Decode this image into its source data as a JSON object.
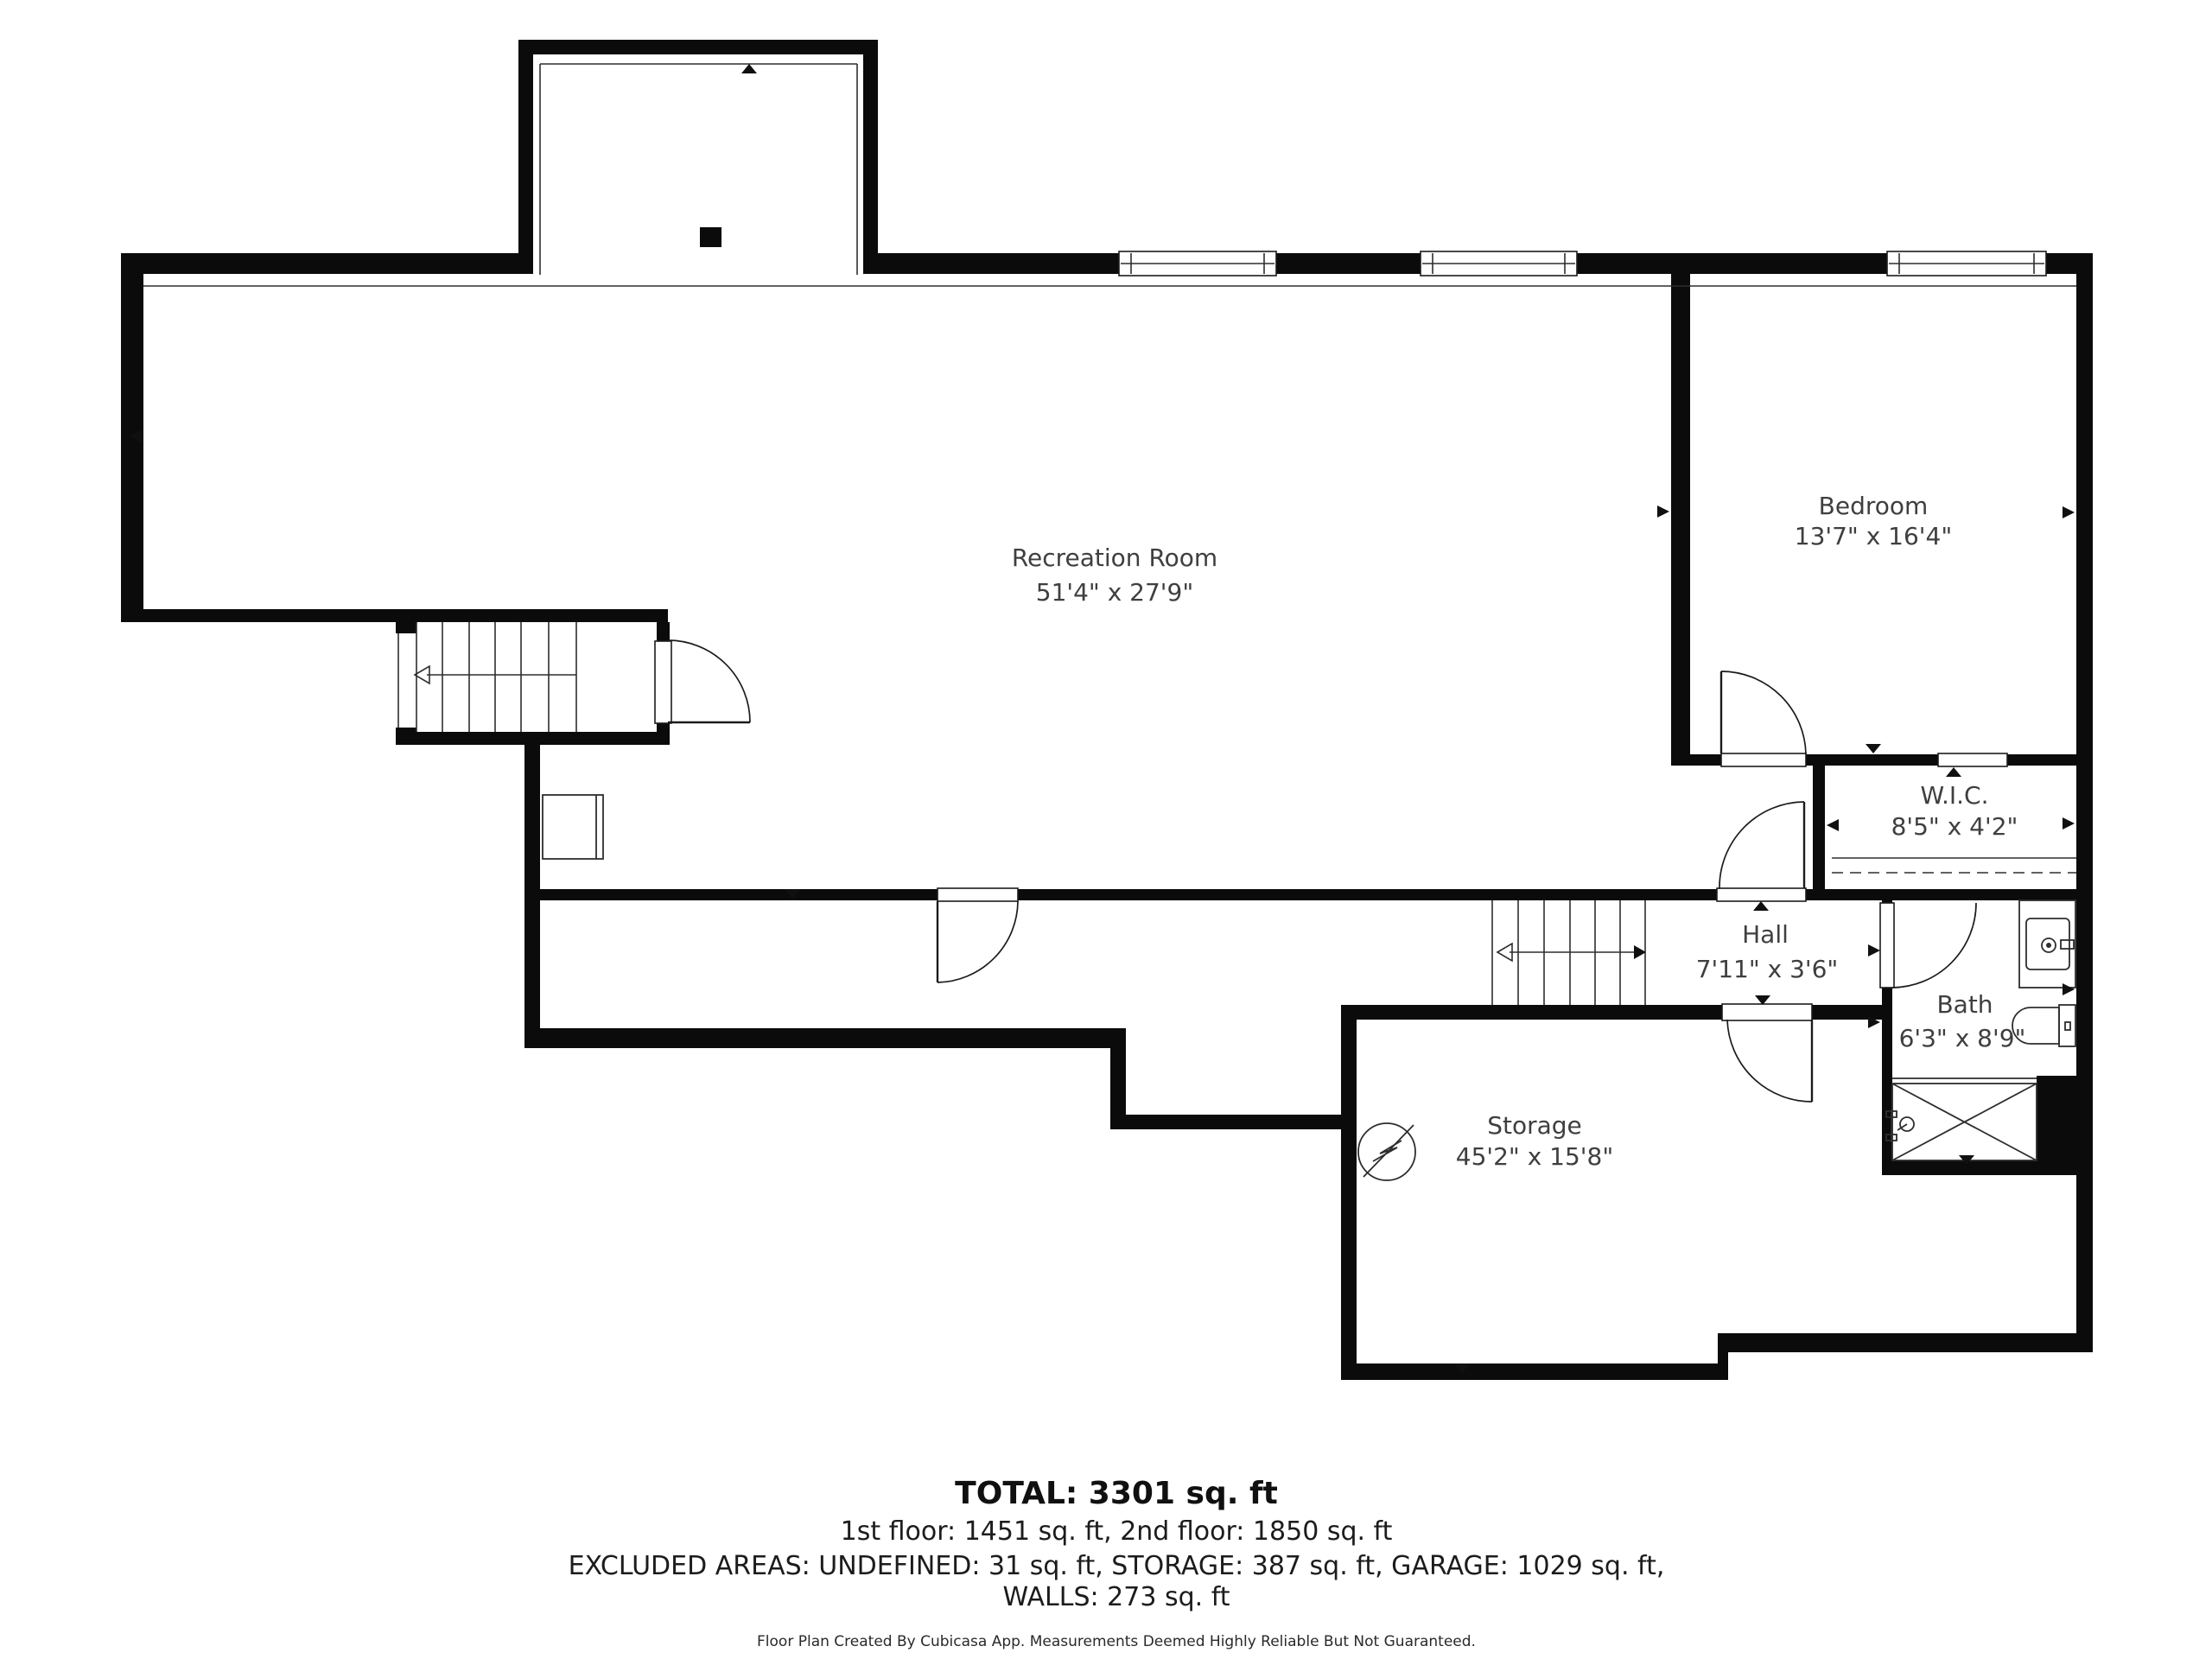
{
  "floorplan": {
    "rooms": [
      {
        "id": "recreation-room",
        "name": "Recreation Room",
        "dims": "51'4\" x 27'9\""
      },
      {
        "id": "bedroom",
        "name": "Bedroom",
        "dims": "13'7\" x 16'4\""
      },
      {
        "id": "wic",
        "name": "W.I.C.",
        "dims": "8'5\" x 4'2\""
      },
      {
        "id": "hall",
        "name": "Hall",
        "dims": "7'11\" x 3'6\""
      },
      {
        "id": "bath",
        "name": "Bath",
        "dims": "6'3\" x 8'9\""
      },
      {
        "id": "storage",
        "name": "Storage",
        "dims": "45'2\" x 15'8\""
      }
    ],
    "summary": {
      "total": "TOTAL: 3301 sq. ft",
      "floors": "1st floor: 1451 sq. ft, 2nd floor: 1850 sq. ft",
      "excluded": "EXCLUDED AREAS: UNDEFINED: 31 sq. ft, STORAGE: 387 sq. ft, GARAGE: 1029 sq. ft,",
      "walls": "WALLS: 273 sq. ft"
    },
    "disclaimer": "Floor Plan Created By Cubicasa App. Measurements Deemed Highly Reliable But Not Guaranteed.",
    "colors": {
      "wall": "#0b0b0b",
      "background": "#ffffff",
      "label_text": "#3f3f3f",
      "summary_text": "#101010"
    }
  }
}
